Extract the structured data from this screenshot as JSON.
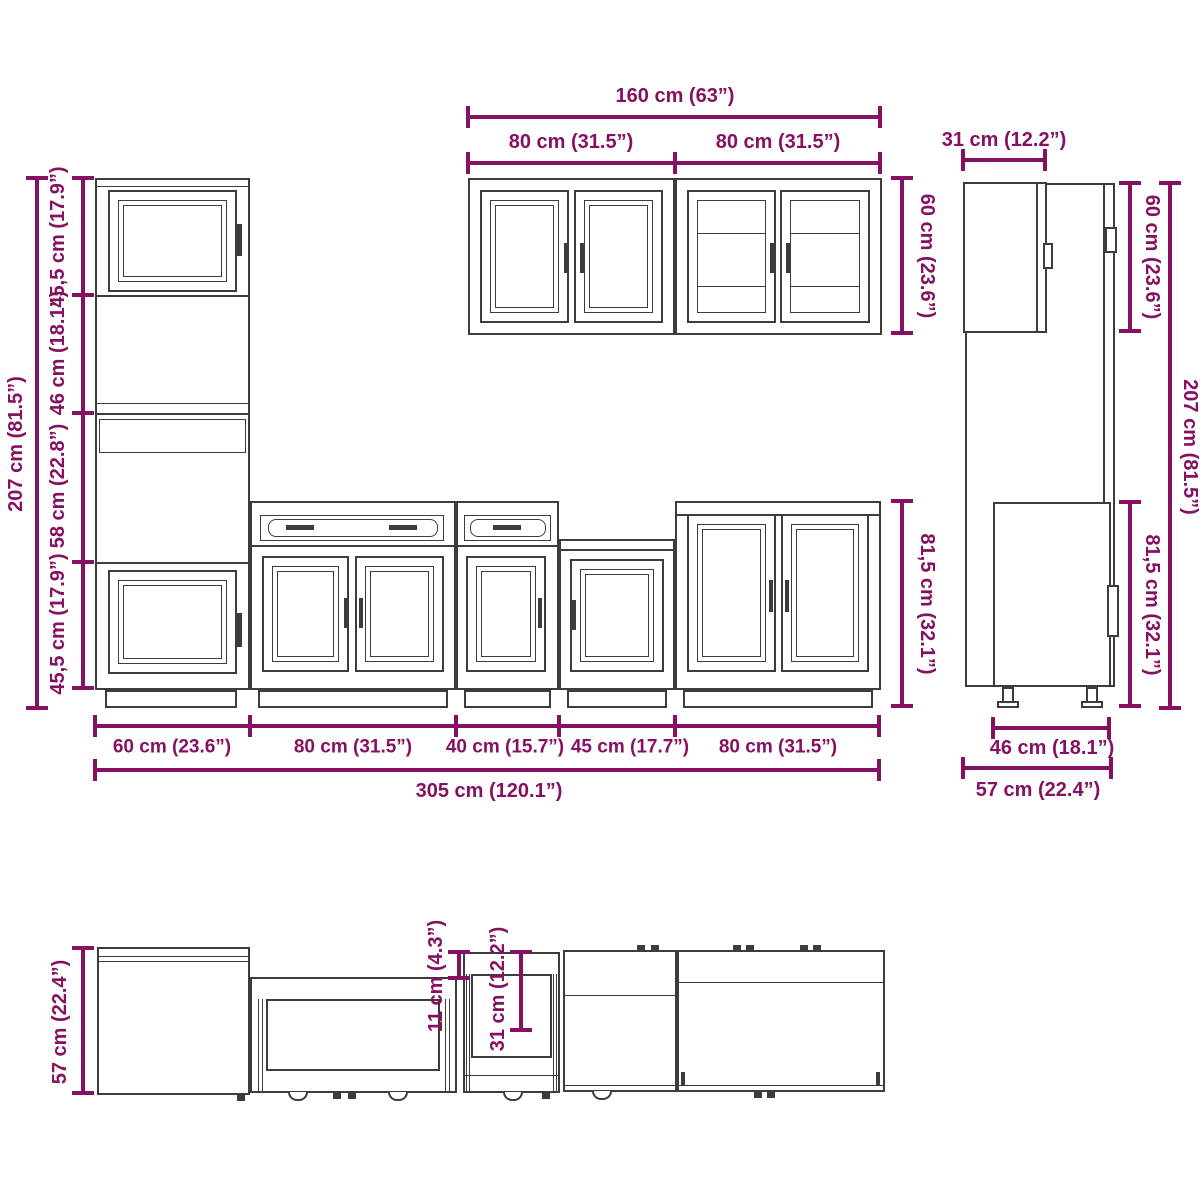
{
  "colors": {
    "dimension": "#861162",
    "cabinet_outline": "#3c3c3c"
  },
  "front_view": {
    "total_height": "207 cm (81.5”)",
    "tall_sections": [
      "45,5 cm (17.9”)",
      "46 cm (18.1”)",
      "58 cm (22.8”)",
      "45,5 cm (17.9”)"
    ],
    "wall_total_width": "160 cm (63”)",
    "wall_widths": [
      "80 cm (31.5”)",
      "80 cm (31.5”)"
    ],
    "wall_height": "60 cm (23.6”)",
    "base_height": "81,5 cm (32.1”)",
    "unit_widths": [
      "60 cm (23.6”)",
      "80 cm (31.5”)",
      "40 cm (15.7”)",
      "45 cm (17.7”)",
      "80 cm (31.5”)"
    ],
    "total_width": "305 cm (120.1”)"
  },
  "side_view": {
    "wall_depth": "31 cm (12.2”)",
    "wall_height": "60 cm (23.6”)",
    "total_height": "207 cm (81.5”)",
    "base_height": "81,5 cm (32.1”)",
    "base_depth": "46 cm (18.1”)",
    "total_depth": "57 cm (22.4”)"
  },
  "top_view": {
    "depth": "57 cm (22.4”)",
    "drawer_front_depth": "11 cm (4.3”)",
    "drawer_depth": "31 cm (12.2”)"
  }
}
